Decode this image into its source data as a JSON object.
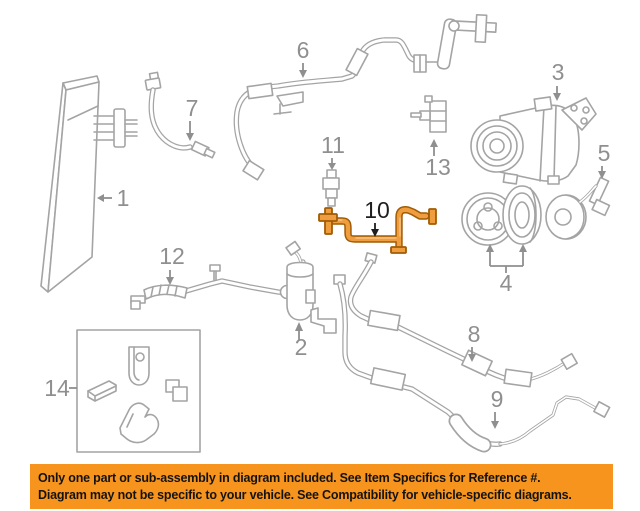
{
  "page": {
    "width": 640,
    "height": 511,
    "background": "#ffffff"
  },
  "diagram": {
    "title": "A/C condenser, compressor and refrigerant lines exploded parts diagram",
    "highlighted_part": "10",
    "colors": {
      "line": "#a4a4a4",
      "label": "#8f8f8f",
      "highlight_fill": "#ef9d3f",
      "highlight_outline": "#a05c04",
      "highlight_label": "#1e1e1e"
    },
    "labels": [
      {
        "text": "1"
      },
      {
        "text": "2"
      },
      {
        "text": "3"
      },
      {
        "text": "4"
      },
      {
        "text": "5"
      },
      {
        "text": "6"
      },
      {
        "text": "7"
      },
      {
        "text": "8"
      },
      {
        "text": "9"
      },
      {
        "text": "10"
      },
      {
        "text": "11"
      },
      {
        "text": "12"
      },
      {
        "text": "13"
      },
      {
        "text": "14"
      }
    ]
  },
  "banner": {
    "background": "#f7941e",
    "text_color": "#131313",
    "line1": "Only one part or sub-assembly in diagram included. See Item Specifics for Reference #.",
    "line2": "Diagram may not be specific to your vehicle. See Compatibility for vehicle-specific diagrams."
  }
}
